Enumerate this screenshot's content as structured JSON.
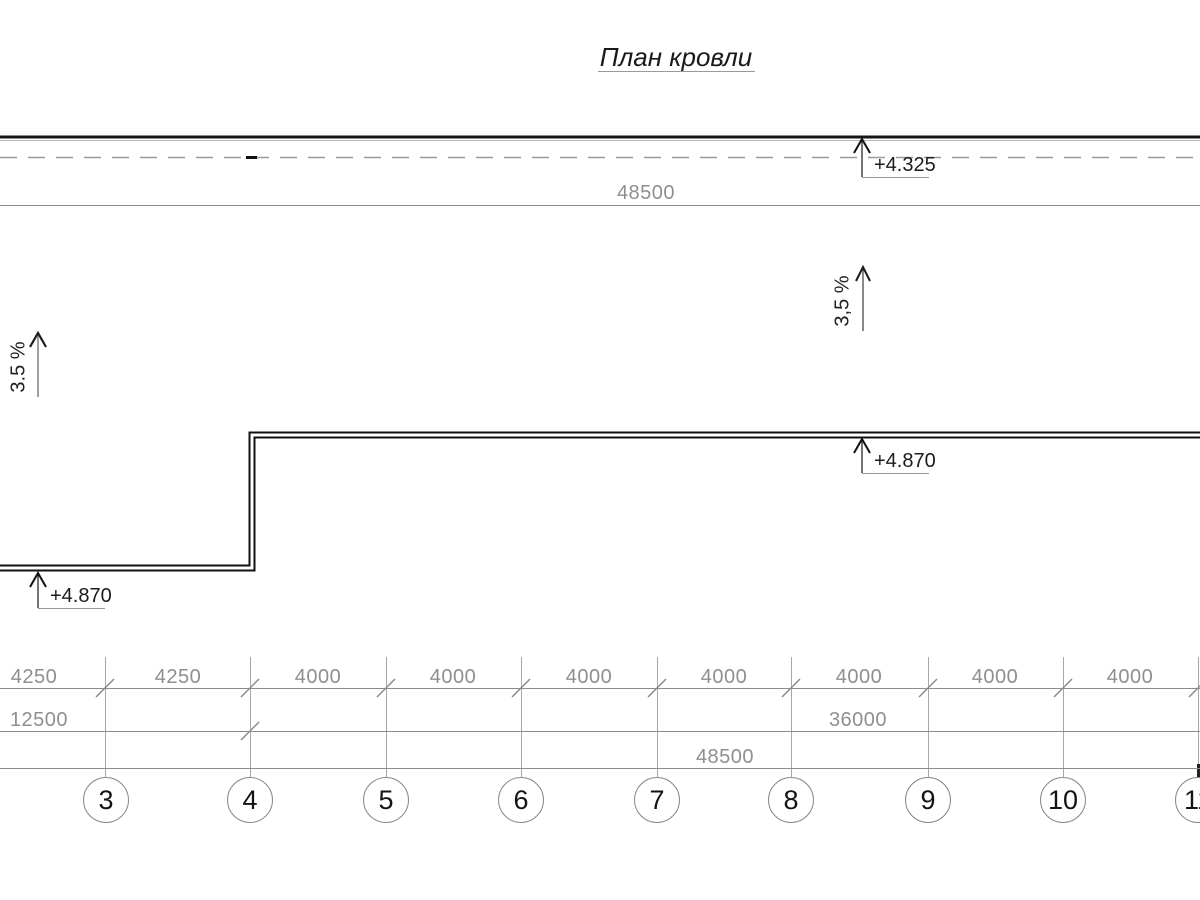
{
  "title": "План кровли",
  "top_area": {
    "overall_dim_label": "48500",
    "elevation_parapet": "+4.325"
  },
  "slopes": {
    "left_label": "3.5 %",
    "right_label": "3,5 %"
  },
  "roof": {
    "elevation_left_edge": "+4.870",
    "elevation_main_edge": "+4.870"
  },
  "dim_rows": {
    "row1": [
      "4250",
      "4250",
      "4000",
      "4000",
      "4000",
      "4000",
      "4000",
      "4000",
      "4000"
    ],
    "row2": [
      "12500",
      "36000"
    ],
    "row3_label": "48500"
  },
  "axis_bubbles": [
    "3",
    "4",
    "5",
    "6",
    "7",
    "8",
    "9",
    "10",
    "11"
  ],
  "colors": {
    "ink": "#1a1a1a",
    "dim_gray": "#8c8c8c",
    "text_gray": "#8f8f8f"
  }
}
